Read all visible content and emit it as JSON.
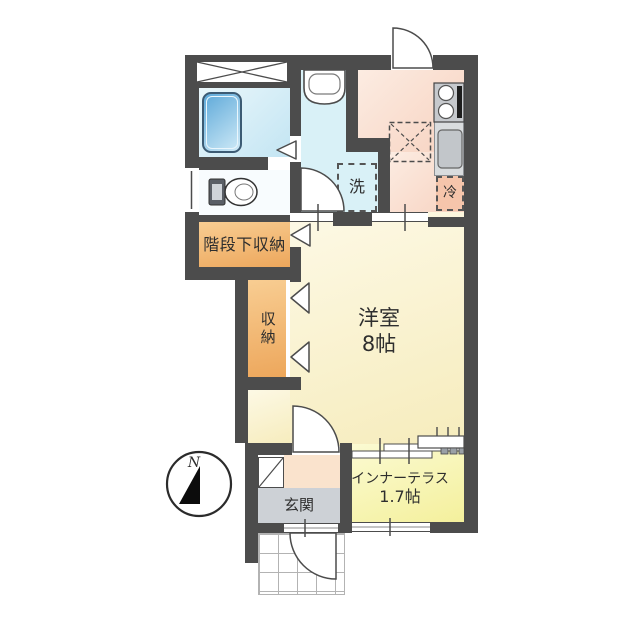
{
  "floorplan": {
    "rooms": {
      "western_room": {
        "name": "洋室",
        "size": "8帖"
      },
      "inner_terrace": {
        "name": "インナーテラス",
        "size": "1.7帖"
      },
      "entrance": {
        "name": "玄関"
      },
      "closet": {
        "name": "収納"
      },
      "under_stairs_storage": {
        "name": "階段下収納"
      }
    },
    "fixtures": {
      "washing_machine": {
        "label": "洗"
      },
      "refrigerator": {
        "label": "冷"
      }
    },
    "compass": {
      "north_label": "N"
    },
    "colors": {
      "wall": "#4c4c4c",
      "western_room": "#f8efc6",
      "inner_terrace": "#f5f1a0",
      "storage": "#f2b979",
      "kitchen": "#f8d8c8",
      "bathroom": "#cfe9f5",
      "washroom": "#d9f1f7",
      "entrance_floor": "#cdd1d6",
      "step": "#fae3cd"
    }
  }
}
